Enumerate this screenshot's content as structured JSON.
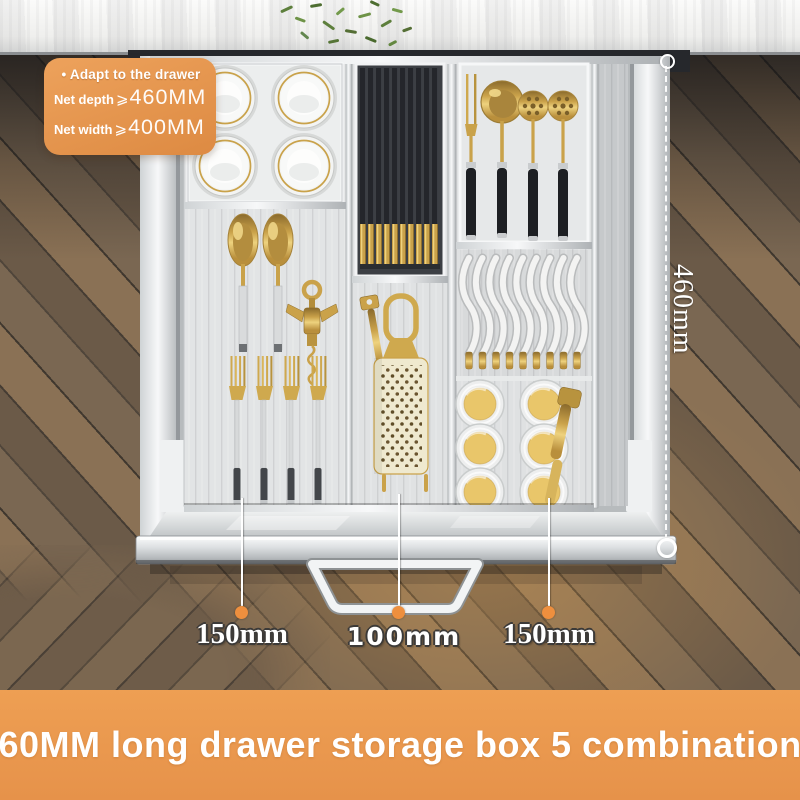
{
  "spec_badge": {
    "bullet": "•",
    "title": "Adapt to the drawer",
    "specs": [
      {
        "label": "Net depth",
        "symbol": "⩾",
        "value": "460MM"
      },
      {
        "label": "Net width",
        "symbol": "⩾",
        "value": "400MM"
      }
    ]
  },
  "dimensions": {
    "depth_label": "460mm",
    "compartment_labels": [
      "150mm",
      "100mm",
      "150mm"
    ]
  },
  "product_banner": {
    "text": "460MM long drawer storage box 5 combinations"
  },
  "colors": {
    "accent_orange": "#e8954a",
    "banner_orange": "#ec9d52",
    "measure_dot_orange": "#ee8f3e",
    "gold": "#c9a24a",
    "label_white": "#ffffff",
    "floor_brown": "#6d5c4a",
    "drawer_silver": "#d9dcde"
  }
}
